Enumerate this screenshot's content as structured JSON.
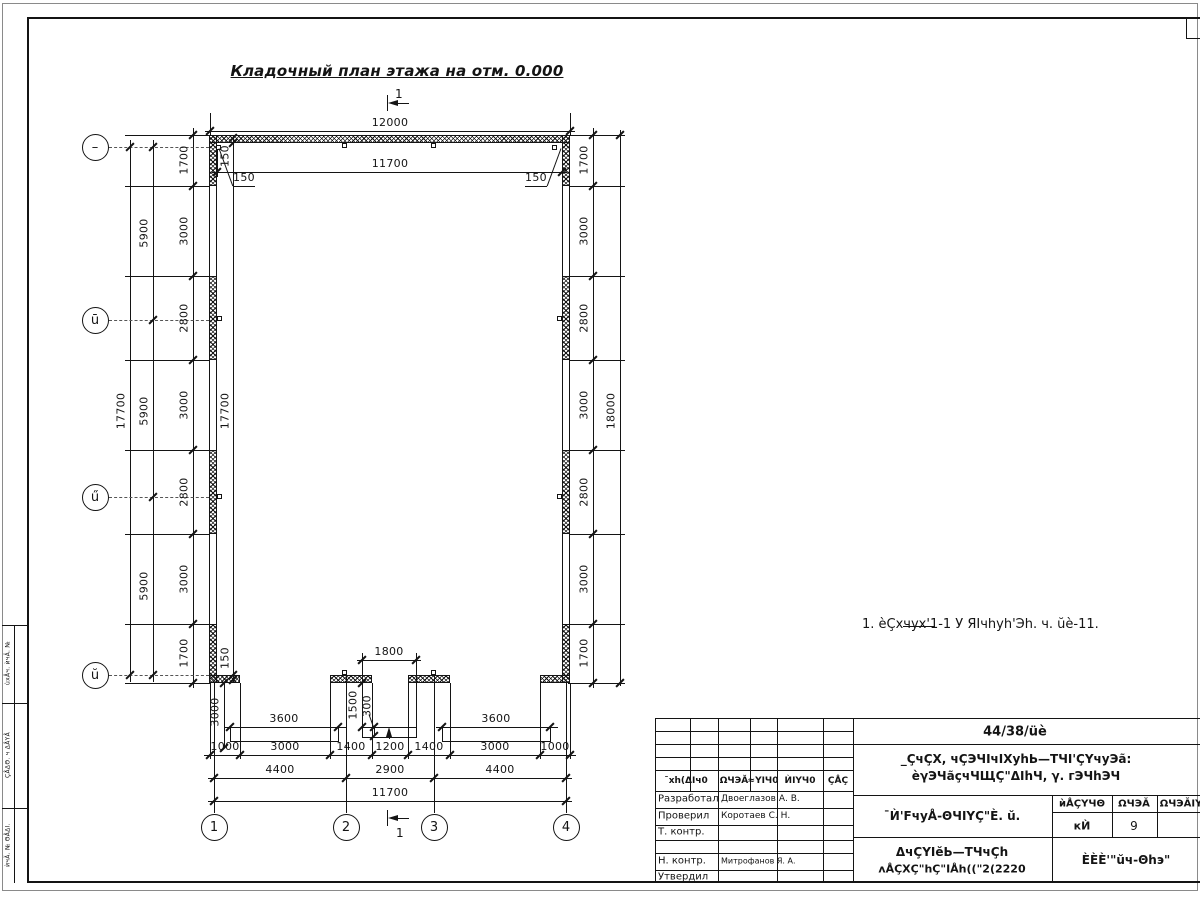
{
  "title": {
    "text": "Кладочный план этажа на отм. 0.000"
  },
  "note": {
    "text": "1. èÇхчух'1-1 У ЯIчhуh'Эh. ч. ŭè-11."
  },
  "axes": {
    "left": [
      "–",
      "ū",
      "ű",
      "ŭ"
    ],
    "bottom": [
      "1",
      "2",
      "3",
      "4"
    ]
  },
  "titleblock": {
    "doc_number": "44/38/üè",
    "object_line1": "_ÇчÇХ, чÇЭЧIчIХуhЬ—ТЧI'ÇҮчуЭã:",
    "object_line2": "èγЭЧãçчЧЩÇ\"ΔIhЧ, γ. гЭЧhЭЧ",
    "sheet_name": "¯Ѝ'FчуÅ-ΘЧIҮÇ\"È. ŭ.",
    "stage_header": [
      "ѝÅÇҮЧΘ",
      "ΩЧЭĂ",
      "ΩЧЭĂIY"
    ],
    "stage": "кЍ",
    "sheet": "9",
    "drawing_name1": "ΔчÇҮIĕЬ—ТЧчÇh",
    "drawing_name2": "ʌÅÇХÇ\"hÇ\"IÅh((\"2(2220",
    "organization": "ÈÈÈ'\"ŭч-Θhэ\"",
    "rev_header": [
      "¯хh(ΔIч0",
      "ΩЧЭĂ",
      "≈YIЧ0",
      "ЍIҮЧ0",
      "ÇÅÇ"
    ],
    "roles": [
      [
        "Разработал",
        "Двоеглазов А. В."
      ],
      [
        "Проверил",
        "Коротаев С. Н."
      ],
      [
        "Т. контр.",
        ""
      ],
      [
        "Н. контр.",
        "Митрофанов Я. А."
      ],
      [
        "Утвердил",
        ""
      ]
    ]
  },
  "drawing": {
    "hlines": [
      [
        205,
        131,
        370
      ],
      [
        212,
        172,
        355
      ],
      [
        357,
        660,
        64
      ],
      [
        224,
        727,
        122
      ],
      [
        436,
        727,
        122
      ],
      [
        204,
        755,
        372
      ],
      [
        208,
        778,
        364
      ],
      [
        208,
        801,
        364
      ],
      [
        125,
        135,
        85
      ],
      [
        125,
        186,
        85
      ],
      [
        125,
        276,
        85
      ],
      [
        125,
        360,
        85
      ],
      [
        125,
        450,
        85
      ],
      [
        125,
        534,
        85
      ],
      [
        125,
        624,
        85
      ],
      [
        125,
        683,
        85
      ],
      [
        568,
        135,
        57
      ],
      [
        568,
        186,
        57
      ],
      [
        568,
        276,
        57
      ],
      [
        568,
        360,
        57
      ],
      [
        568,
        450,
        57
      ],
      [
        568,
        534,
        57
      ],
      [
        568,
        624,
        57
      ],
      [
        568,
        683,
        57
      ],
      [
        233,
        186,
        22
      ],
      [
        525,
        186,
        22
      ],
      [
        392,
        103,
        17
      ],
      [
        392,
        818,
        17
      ],
      [
        903,
        626,
        32
      ],
      [
        655,
        718,
        545
      ],
      [
        655,
        731,
        198
      ],
      [
        655,
        744,
        198
      ],
      [
        655,
        757,
        198
      ],
      [
        655,
        770,
        198
      ],
      [
        655,
        791,
        198
      ],
      [
        655,
        808,
        198
      ],
      [
        655,
        825,
        198
      ],
      [
        655,
        840,
        198
      ],
      [
        655,
        853,
        198
      ],
      [
        655,
        870,
        198
      ],
      [
        853,
        744,
        347
      ],
      [
        853,
        795,
        347
      ],
      [
        1052,
        812,
        148
      ],
      [
        853,
        837,
        347
      ],
      [
        2,
        625,
        25
      ],
      [
        2,
        703,
        25
      ],
      [
        2,
        808,
        25
      ],
      [
        1186,
        38,
        14
      ]
    ],
    "vlines": [
      [
        210,
        113,
        22
      ],
      [
        570,
        113,
        22
      ],
      [
        217,
        145,
        32
      ],
      [
        562,
        145,
        32
      ],
      [
        387,
        95,
        16
      ],
      [
        387,
        810,
        16
      ],
      [
        210,
        683,
        76
      ],
      [
        240,
        683,
        76
      ],
      [
        330,
        683,
        76
      ],
      [
        372,
        683,
        76
      ],
      [
        408,
        683,
        76
      ],
      [
        450,
        683,
        76
      ],
      [
        540,
        683,
        76
      ],
      [
        570,
        683,
        76
      ],
      [
        214,
        683,
        130
      ],
      [
        346,
        675,
        138
      ],
      [
        434,
        675,
        138
      ],
      [
        566,
        683,
        130
      ],
      [
        362,
        653,
        74
      ],
      [
        416,
        653,
        74
      ],
      [
        374,
        727,
        9
      ],
      [
        389,
        734,
        5
      ],
      [
        130,
        140,
        542
      ],
      [
        153,
        140,
        542
      ],
      [
        193,
        128,
        560
      ],
      [
        233,
        135,
        548
      ],
      [
        593,
        128,
        560
      ],
      [
        620,
        130,
        556
      ],
      [
        224,
        683,
        65
      ],
      [
        655,
        718,
        165
      ],
      [
        690,
        718,
        73
      ],
      [
        750,
        718,
        73
      ],
      [
        718,
        718,
        165
      ],
      [
        777,
        718,
        165
      ],
      [
        823,
        718,
        165
      ],
      [
        853,
        718,
        165
      ],
      [
        1052,
        795,
        88
      ],
      [
        1112,
        795,
        42
      ],
      [
        1157,
        795,
        42
      ],
      [
        14,
        625,
        258
      ],
      [
        1186,
        17,
        21
      ]
    ],
    "dash": [
      [
        109,
        147,
        100
      ],
      [
        109,
        320,
        100
      ],
      [
        109,
        497,
        100
      ],
      [
        109,
        675,
        100
      ]
    ],
    "ticks": [
      [
        210,
        131
      ],
      [
        570,
        131
      ],
      [
        217,
        172
      ],
      [
        562,
        172
      ],
      [
        362,
        660
      ],
      [
        416,
        660
      ],
      [
        230,
        727
      ],
      [
        338,
        727
      ],
      [
        442,
        727
      ],
      [
        550,
        727
      ],
      [
        210,
        755
      ],
      [
        240,
        755
      ],
      [
        330,
        755
      ],
      [
        372,
        755
      ],
      [
        408,
        755
      ],
      [
        450,
        755
      ],
      [
        540,
        755
      ],
      [
        570,
        755
      ],
      [
        214,
        778
      ],
      [
        346,
        778
      ],
      [
        434,
        778
      ],
      [
        566,
        778
      ],
      [
        214,
        801
      ],
      [
        566,
        801
      ],
      [
        130,
        147
      ],
      [
        130,
        675
      ],
      [
        153,
        147
      ],
      [
        153,
        320
      ],
      [
        153,
        497
      ],
      [
        153,
        675
      ],
      [
        193,
        135
      ],
      [
        193,
        186
      ],
      [
        193,
        276
      ],
      [
        193,
        360
      ],
      [
        193,
        450
      ],
      [
        193,
        534
      ],
      [
        193,
        624
      ],
      [
        193,
        683
      ],
      [
        233,
        138
      ],
      [
        233,
        143
      ],
      [
        233,
        675
      ],
      [
        233,
        680
      ],
      [
        593,
        135
      ],
      [
        593,
        186
      ],
      [
        593,
        276
      ],
      [
        593,
        360
      ],
      [
        593,
        450
      ],
      [
        593,
        534
      ],
      [
        593,
        624
      ],
      [
        593,
        683
      ],
      [
        620,
        135
      ],
      [
        620,
        683
      ],
      [
        362,
        683
      ],
      [
        362,
        727
      ],
      [
        224,
        683
      ],
      [
        224,
        748
      ],
      [
        374,
        727
      ],
      [
        374,
        736
      ]
    ],
    "rects": [
      {
        "k": "hatch",
        "x": 209,
        "y": 135,
        "w": 361,
        "h": 8
      },
      {
        "k": "hatch",
        "x": 209,
        "y": 135,
        "w": 8,
        "h": 51
      },
      {
        "k": "hatch",
        "x": 209,
        "y": 276,
        "w": 8,
        "h": 84
      },
      {
        "k": "hatch",
        "x": 209,
        "y": 450,
        "w": 8,
        "h": 84
      },
      {
        "k": "hatch",
        "x": 209,
        "y": 624,
        "w": 8,
        "h": 59
      },
      {
        "k": "hatch",
        "x": 562,
        "y": 135,
        "w": 8,
        "h": 51
      },
      {
        "k": "hatch",
        "x": 562,
        "y": 276,
        "w": 8,
        "h": 84
      },
      {
        "k": "hatch",
        "x": 562,
        "y": 450,
        "w": 8,
        "h": 84
      },
      {
        "k": "hatch",
        "x": 562,
        "y": 624,
        "w": 8,
        "h": 59
      },
      {
        "k": "hatch",
        "x": 209,
        "y": 675,
        "w": 31,
        "h": 8
      },
      {
        "k": "hatch",
        "x": 330,
        "y": 675,
        "w": 42,
        "h": 8
      },
      {
        "k": "hatch",
        "x": 408,
        "y": 675,
        "w": 42,
        "h": 8
      },
      {
        "k": "hatch",
        "x": 540,
        "y": 675,
        "w": 30,
        "h": 8
      },
      {
        "k": "openv",
        "x": 209,
        "y": 186,
        "w": 8,
        "h": 90
      },
      {
        "k": "openv",
        "x": 209,
        "y": 360,
        "w": 8,
        "h": 90
      },
      {
        "k": "openv",
        "x": 209,
        "y": 534,
        "w": 8,
        "h": 90
      },
      {
        "k": "openv",
        "x": 562,
        "y": 186,
        "w": 8,
        "h": 90
      },
      {
        "k": "openv",
        "x": 562,
        "y": 360,
        "w": 8,
        "h": 90
      },
      {
        "k": "openv",
        "x": 562,
        "y": 534,
        "w": 8,
        "h": 90
      },
      {
        "k": "box",
        "x": 230,
        "y": 727,
        "w": 109,
        "h": 15
      },
      {
        "k": "box",
        "x": 442,
        "y": 727,
        "w": 109,
        "h": 15
      },
      {
        "k": "box",
        "x": 362,
        "y": 727,
        "w": 55,
        "h": 11
      },
      {
        "k": "sq",
        "x": 216,
        "y": 145
      },
      {
        "k": "sq",
        "x": 552,
        "y": 145
      },
      {
        "k": "sq",
        "x": 342,
        "y": 143
      },
      {
        "k": "sq",
        "x": 431,
        "y": 143
      },
      {
        "k": "sq",
        "x": 217,
        "y": 316
      },
      {
        "k": "sq",
        "x": 217,
        "y": 494
      },
      {
        "k": "sq",
        "x": 557,
        "y": 316
      },
      {
        "k": "sq",
        "x": 557,
        "y": 494
      },
      {
        "k": "sq",
        "x": 342,
        "y": 670
      },
      {
        "k": "sq",
        "x": 431,
        "y": 670
      }
    ],
    "dimtexts": [
      [
        "12000",
        390,
        129
      ],
      [
        "11700",
        390,
        170
      ],
      [
        "150",
        244,
        184
      ],
      [
        "150",
        536,
        184
      ],
      [
        "1800",
        389,
        658
      ],
      [
        "3600",
        284,
        725
      ],
      [
        "3600",
        496,
        725
      ],
      [
        "1000",
        225,
        753
      ],
      [
        "3000",
        285,
        753
      ],
      [
        "1400",
        351,
        753
      ],
      [
        "1200",
        390,
        753
      ],
      [
        "1400",
        429,
        753
      ],
      [
        "3000",
        495,
        753
      ],
      [
        "1000",
        555,
        753
      ],
      [
        "4400",
        280,
        776
      ],
      [
        "2900",
        390,
        776
      ],
      [
        "4400",
        500,
        776
      ],
      [
        "11700",
        390,
        799
      ],
      [
        "1",
        399,
        101,
        12
      ],
      [
        "1",
        400,
        840,
        12
      ]
    ],
    "vtexts": [
      [
        "17700",
        121,
        411
      ],
      [
        "5900",
        144,
        233
      ],
      [
        "5900",
        144,
        411
      ],
      [
        "5900",
        144,
        586
      ],
      [
        "1700",
        184,
        160
      ],
      [
        "3000",
        184,
        231
      ],
      [
        "2800",
        184,
        318
      ],
      [
        "3000",
        184,
        405
      ],
      [
        "2800",
        184,
        492
      ],
      [
        "3000",
        184,
        579
      ],
      [
        "1700",
        184,
        653
      ],
      [
        "150",
        225,
        156
      ],
      [
        "17700",
        225,
        411
      ],
      [
        "150",
        225,
        658
      ],
      [
        "1700",
        584,
        160
      ],
      [
        "3000",
        584,
        231
      ],
      [
        "2800",
        584,
        318
      ],
      [
        "3000",
        584,
        405
      ],
      [
        "2800",
        584,
        492
      ],
      [
        "3000",
        584,
        579
      ],
      [
        "1700",
        584,
        653
      ],
      [
        "18000",
        611,
        411
      ],
      [
        "3000",
        215,
        712
      ],
      [
        "1500",
        353,
        705
      ],
      [
        "300",
        367,
        706
      ],
      [
        "ùхÅч. ѝчĂ. №",
        8,
        663,
        6
      ],
      [
        "ÇÅΔΘ. ч ΔÅҮÅ",
        8,
        755,
        6
      ],
      [
        "ѝчĂ. № ΘÅΔI.",
        8,
        845,
        6
      ]
    ],
    "labels": [
      {
        "t": "44/38/üè",
        "x": 1015,
        "y": 732,
        "fs": 13,
        "b": 1
      },
      {
        "t": "_ÇчÇХ, чÇЭЧIчIХуhЬ—ТЧI'ÇҮчуЭã:",
        "x": 1016,
        "y": 759,
        "fs": 12,
        "b": 1
      },
      {
        "t": "èγЭЧãçчЧЩÇ\"ΔIhЧ, γ. гЭЧhЭЧ",
        "x": 1016,
        "y": 776,
        "fs": 12,
        "b": 1
      },
      {
        "t": "¯Ѝ'FчуÅ-ΘЧIҮÇ\"È. ŭ.",
        "x": 952,
        "y": 816,
        "fs": 12,
        "b": 1
      },
      {
        "t": "ѝÅÇҮЧΘ",
        "x": 1082,
        "y": 804,
        "fs": 10,
        "b": 1
      },
      {
        "t": "ΩЧЭĂ",
        "x": 1134,
        "y": 804,
        "fs": 10,
        "b": 1
      },
      {
        "t": "ΩЧЭĂIY",
        "x": 1181,
        "y": 804,
        "fs": 10,
        "b": 1
      },
      {
        "t": "кЍ",
        "x": 1082,
        "y": 826,
        "fs": 11,
        "b": 1
      },
      {
        "t": "9",
        "x": 1134,
        "y": 826,
        "fs": 12
      },
      {
        "t": "ΔчÇҮIĕЬ—ТЧчÇh",
        "x": 952,
        "y": 852,
        "fs": 12,
        "b": 1
      },
      {
        "t": "ʌÅÇХÇ\"hÇ\"IÅh((\"2(2220",
        "x": 952,
        "y": 869,
        "fs": 11,
        "b": 1
      },
      {
        "t": "ÈÈÈ'\"ŭч-Θhэ\"",
        "x": 1126,
        "y": 860,
        "fs": 12,
        "b": 1
      },
      {
        "t": "¯хh(ΔIч0",
        "x": 686,
        "y": 781,
        "fs": 9,
        "b": 1
      },
      {
        "t": "ΩЧЭĂ",
        "x": 734,
        "y": 781,
        "fs": 9,
        "b": 1
      },
      {
        "t": "≈YIЧ0",
        "x": 763,
        "y": 781,
        "fs": 9,
        "b": 1
      },
      {
        "t": "ЍIҮЧ0",
        "x": 800,
        "y": 781,
        "fs": 9,
        "b": 1
      },
      {
        "t": "ÇÅÇ",
        "x": 838,
        "y": 781,
        "fs": 9,
        "b": 1
      },
      {
        "t": "Разработал",
        "x": 658,
        "y": 799,
        "fs": 10,
        "al": "l"
      },
      {
        "t": "Двоеглазов А. В.",
        "x": 721,
        "y": 799,
        "fs": 9,
        "al": "l"
      },
      {
        "t": "Проверил",
        "x": 658,
        "y": 816,
        "fs": 10,
        "al": "l"
      },
      {
        "t": "Коротаев С. Н.",
        "x": 721,
        "y": 816,
        "fs": 9,
        "al": "l"
      },
      {
        "t": "Т. контр.",
        "x": 658,
        "y": 832,
        "fs": 10,
        "al": "l"
      },
      {
        "t": "Н. контр.",
        "x": 658,
        "y": 861,
        "fs": 10,
        "al": "l"
      },
      {
        "t": "Митрофанов Я. А.",
        "x": 721,
        "y": 861,
        "fs": 8,
        "al": "l"
      },
      {
        "t": "Утвердил",
        "x": 658,
        "y": 877,
        "fs": 10,
        "al": "l"
      }
    ],
    "circles": [
      {
        "x": 95,
        "y": 147,
        "t": "–"
      },
      {
        "x": 95,
        "y": 320,
        "t": "ū"
      },
      {
        "x": 95,
        "y": 497,
        "t": "ű"
      },
      {
        "x": 95,
        "y": 675,
        "t": "ŭ"
      },
      {
        "x": 214,
        "y": 827,
        "t": "1"
      },
      {
        "x": 346,
        "y": 827,
        "t": "2"
      },
      {
        "x": 434,
        "y": 827,
        "t": "3"
      },
      {
        "x": 566,
        "y": 827,
        "t": "4"
      }
    ],
    "leaders": [
      [
        219,
        148,
        233,
        186
      ],
      [
        561,
        148,
        547,
        186
      ],
      [
        369,
        714,
        374,
        728
      ]
    ],
    "arrows": [
      {
        "x": 388,
        "y": 103,
        "d": "l"
      },
      {
        "x": 388,
        "y": 818,
        "d": "l"
      },
      {
        "x": 389,
        "y": 727,
        "d": "u"
      }
    ]
  }
}
